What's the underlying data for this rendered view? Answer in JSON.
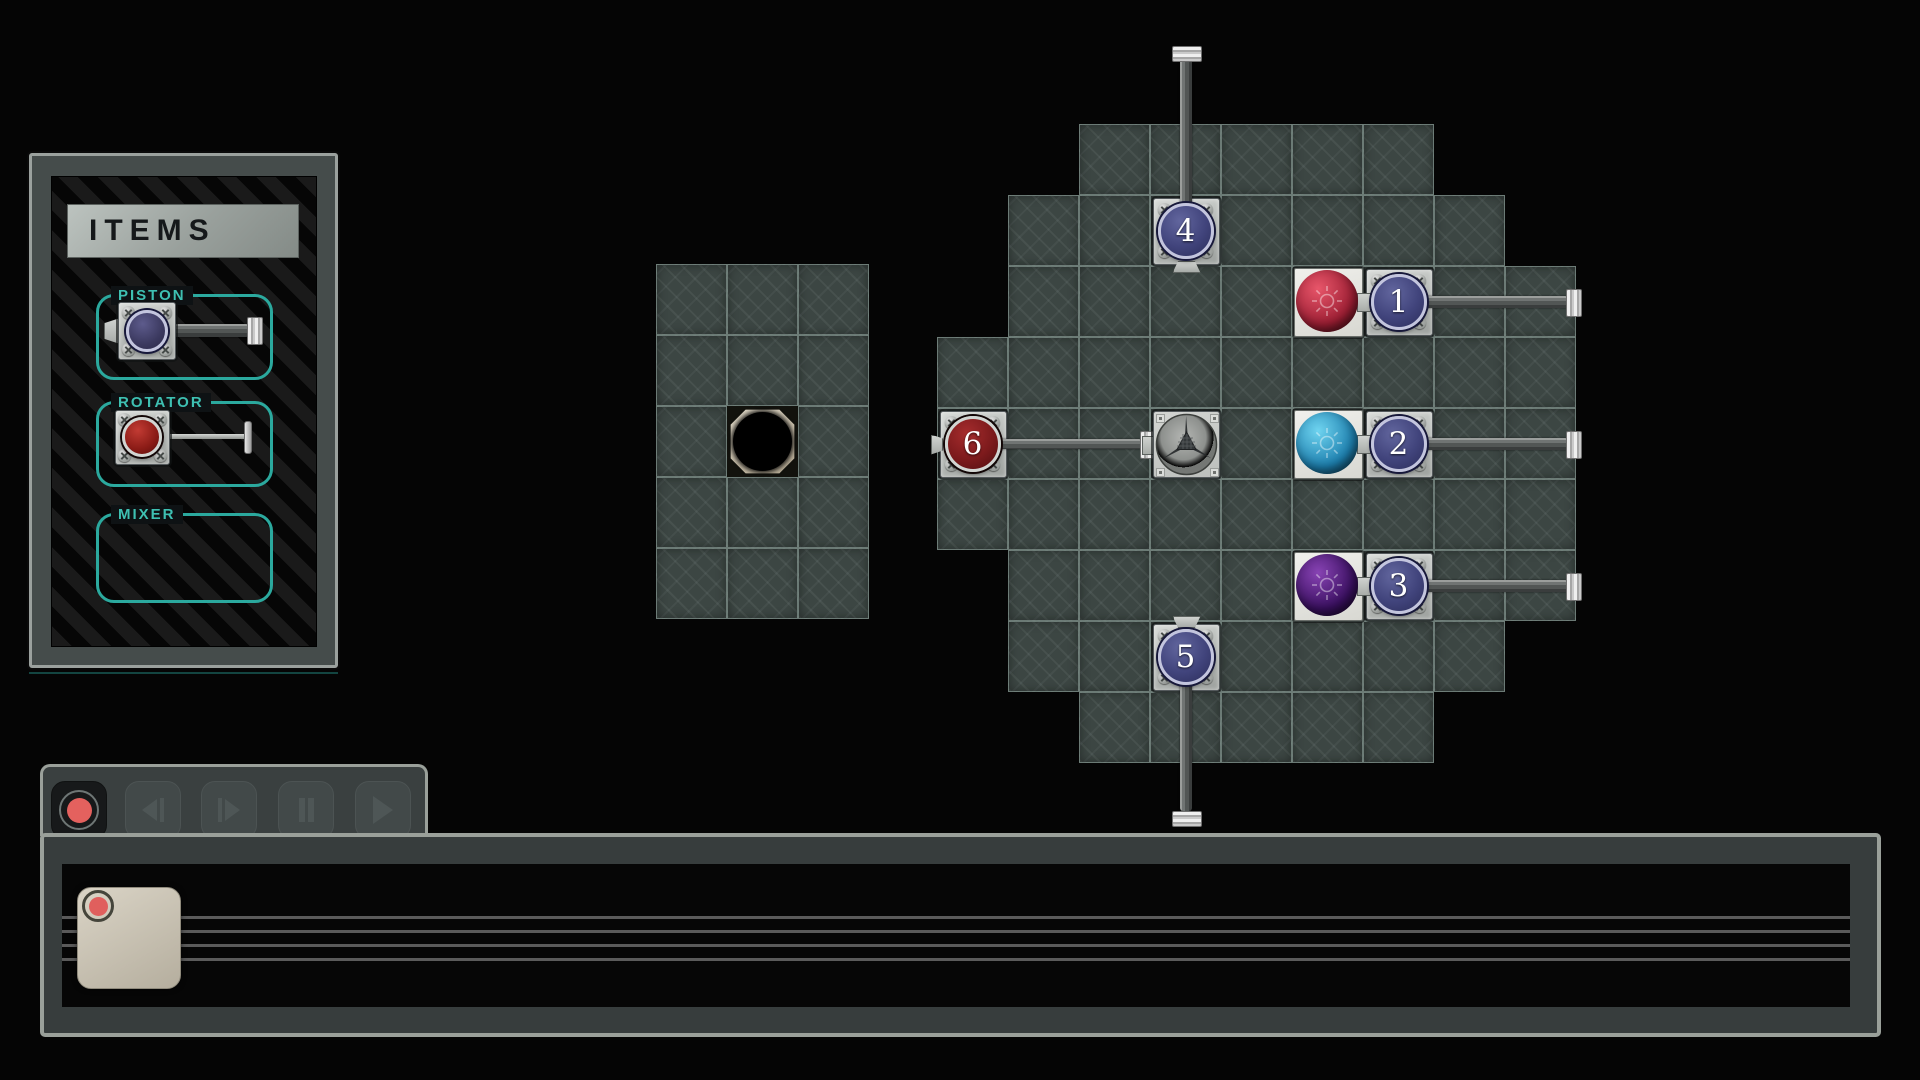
{
  "colors": {
    "teal_accent": "#2ba99e",
    "record_red": "#e4615e",
    "node_navy": "#41447c",
    "node_red": "#7c1a1c",
    "orb_red": [
      "#e8566a",
      "#9c1e33"
    ],
    "orb_cyan": [
      "#6fd4f0",
      "#1d7fae"
    ],
    "orb_purple": [
      "#8843b4",
      "#3a1060"
    ],
    "tile": "#3c4643",
    "grout": "#92a69f"
  },
  "items_panel": {
    "title": "ITEMS",
    "groups": [
      {
        "label": "PISTON",
        "item": "piston-sample"
      },
      {
        "label": "ROTATOR",
        "item": "rotator-sample"
      },
      {
        "label": "MIXER",
        "item": "none"
      }
    ]
  },
  "boards": [
    {
      "name": "left-board",
      "x": 656,
      "y": 264,
      "tile": 71,
      "rows": [
        [
          0,
          3
        ],
        [
          0,
          3
        ],
        [
          0,
          3
        ],
        [
          0,
          3
        ],
        [
          0,
          3
        ]
      ]
    },
    {
      "name": "main-board",
      "x": 937,
      "y": 124,
      "tile": 71,
      "rows": [
        [
          2,
          7
        ],
        [
          1,
          8
        ],
        [
          1,
          9
        ],
        [
          0,
          9
        ],
        [
          0,
          9
        ],
        [
          0,
          9
        ],
        [
          1,
          9
        ],
        [
          1,
          8
        ],
        [
          2,
          7
        ]
      ]
    }
  ],
  "pieces": {
    "hole": {
      "board": 0,
      "row": 2,
      "col": 1
    },
    "fan": {
      "board": 1,
      "row": 4,
      "col": 3
    },
    "orbs": [
      {
        "board": 1,
        "row": 2,
        "col": 5,
        "color": "orb_red"
      },
      {
        "board": 1,
        "row": 4,
        "col": 5,
        "color": "orb_cyan"
      },
      {
        "board": 1,
        "row": 6,
        "col": 5,
        "color": "orb_purple"
      }
    ],
    "nodes": [
      {
        "label": "1",
        "board": 1,
        "row": 2,
        "col": 6,
        "kind": "piston",
        "dir": "right",
        "rod_to": 1578
      },
      {
        "label": "2",
        "board": 1,
        "row": 4,
        "col": 6,
        "kind": "piston",
        "dir": "right",
        "rod_to": 1578
      },
      {
        "label": "3",
        "board": 1,
        "row": 6,
        "col": 6,
        "kind": "piston",
        "dir": "right",
        "rod_to": 1578
      },
      {
        "label": "4",
        "board": 1,
        "row": 1,
        "col": 3,
        "kind": "piston",
        "dir": "up",
        "rod_to": 46
      },
      {
        "label": "5",
        "board": 1,
        "row": 7,
        "col": 3,
        "kind": "piston",
        "dir": "down",
        "rod_to": 813
      },
      {
        "label": "6",
        "board": 1,
        "row": 4,
        "col": 0,
        "kind": "rotator",
        "dir": "right",
        "rod_to": 1152
      }
    ]
  },
  "transport": {
    "buttons": [
      {
        "name": "record",
        "icon": "record-icon",
        "state": "active"
      },
      {
        "name": "step-back",
        "icon": "step-back-icon",
        "state": "disabled"
      },
      {
        "name": "step-forward",
        "icon": "step-forward-icon",
        "state": "disabled"
      },
      {
        "name": "pause",
        "icon": "pause-icon",
        "state": "disabled"
      },
      {
        "name": "play",
        "icon": "play-icon",
        "state": "disabled"
      }
    ]
  },
  "timeline": {
    "staff_line_count": 4,
    "cards": [
      {
        "marker": "record-dot"
      }
    ]
  }
}
